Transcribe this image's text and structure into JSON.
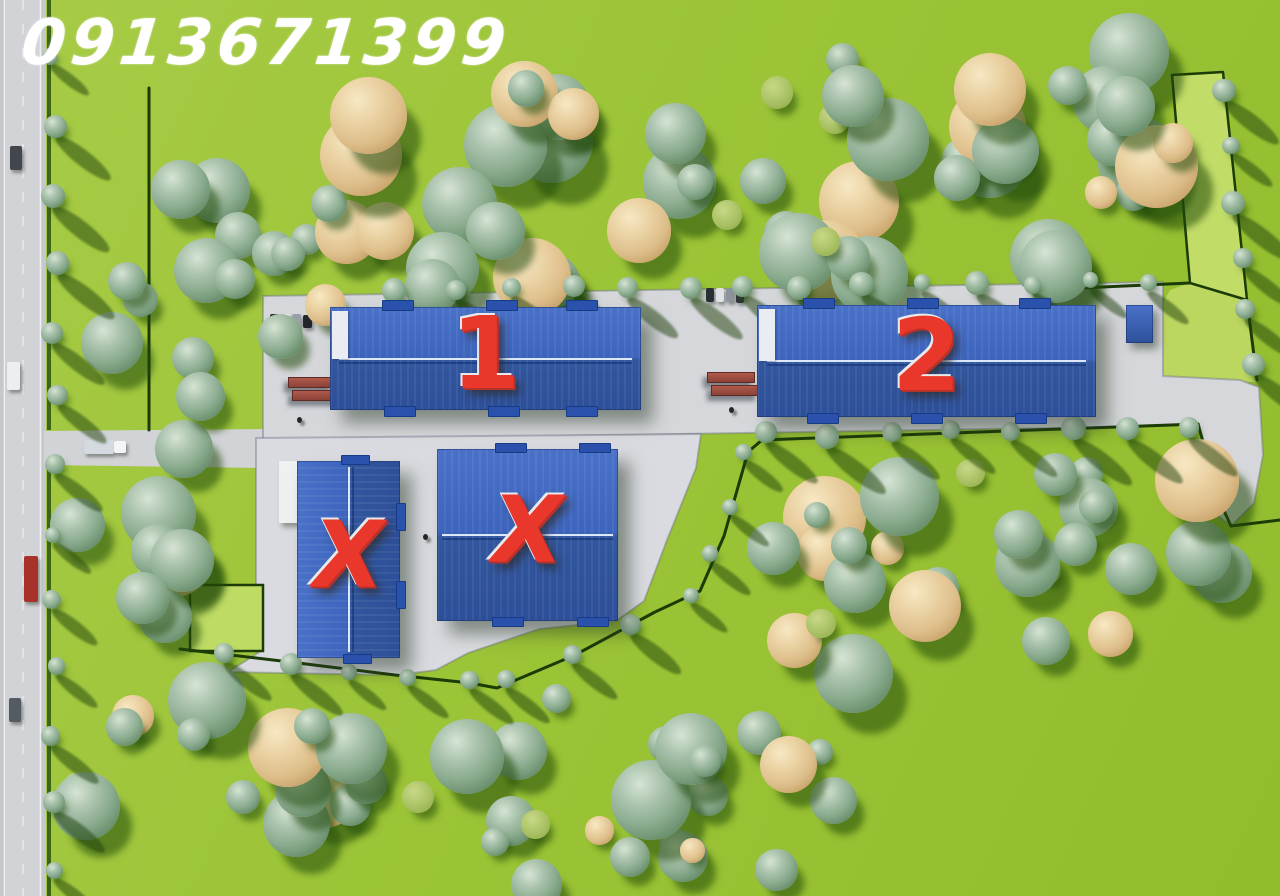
{
  "watermark": {
    "phone": "0913671399"
  },
  "buildings": [
    {
      "id": "warehouse-1",
      "label": "1"
    },
    {
      "id": "warehouse-2",
      "label": "2"
    },
    {
      "id": "warehouse-x-left",
      "label": "X"
    },
    {
      "id": "warehouse-x-center",
      "label": "X"
    }
  ],
  "colors": {
    "grass": "#9cc437",
    "grass_light_parcel": "#c2dc68",
    "pavement": "#d6d7db",
    "road": "#c6c7cb",
    "roof_blue_top": "#4a71c8",
    "roof_blue_bottom": "#2d4f99",
    "ridge_light": "#dde9fb",
    "label_red": "#ea372c",
    "boundary_dark": "#1c3b07",
    "tree_green": "#8aab8e",
    "tree_tan": "#ddbe8a",
    "dock_red": "#9c4b3f",
    "watermark_white": "#ffffff"
  },
  "scene": {
    "clusters": [
      {
        "cx": 215,
        "cy": 305,
        "rx": 115,
        "ry": 155,
        "n": 17,
        "seed": 7
      },
      {
        "cx": 515,
        "cy": 182,
        "rx": 195,
        "ry": 118,
        "n": 22,
        "seed": 13
      },
      {
        "cx": 850,
        "cy": 158,
        "rx": 155,
        "ry": 128,
        "n": 19,
        "seed": 29
      },
      {
        "cx": 1068,
        "cy": 158,
        "rx": 112,
        "ry": 128,
        "n": 14,
        "seed": 41
      },
      {
        "cx": 905,
        "cy": 570,
        "rx": 145,
        "ry": 122,
        "n": 16,
        "seed": 53
      },
      {
        "cx": 1118,
        "cy": 572,
        "rx": 115,
        "ry": 128,
        "n": 13,
        "seed": 67
      },
      {
        "cx": 215,
        "cy": 795,
        "rx": 175,
        "ry": 100,
        "n": 17,
        "seed": 79
      },
      {
        "cx": 555,
        "cy": 795,
        "rx": 175,
        "ry": 100,
        "n": 17,
        "seed": 97
      },
      {
        "cx": 122,
        "cy": 560,
        "rx": 70,
        "ry": 88,
        "n": 7,
        "seed": 103
      },
      {
        "cx": 755,
        "cy": 800,
        "rx": 85,
        "ry": 85,
        "n": 7,
        "seed": 113
      }
    ],
    "boundary_tree_rows": [
      {
        "x1": 54,
        "y1": 58,
        "x2": 54,
        "y2": 872,
        "n": 13
      },
      {
        "x1": 398,
        "y1": 290,
        "x2": 1150,
        "y2": 282,
        "n": 14
      },
      {
        "x1": 1228,
        "y1": 88,
        "x2": 1250,
        "y2": 368,
        "n": 6
      },
      {
        "x1": 770,
        "y1": 436,
        "x2": 1190,
        "y2": 425,
        "n": 8
      },
      {
        "x1": 228,
        "y1": 655,
        "x2": 468,
        "y2": 682,
        "n": 5
      },
      {
        "x1": 510,
        "y1": 679,
        "x2": 692,
        "y2": 597,
        "n": 4
      },
      {
        "x1": 714,
        "y1": 552,
        "x2": 746,
        "y2": 456,
        "n": 3
      }
    ],
    "vehicles": [
      {
        "x": 10,
        "y": 146,
        "w": 12,
        "h": 24,
        "c": "#42464d"
      },
      {
        "x": 7,
        "y": 362,
        "w": 13,
        "h": 28,
        "c": "#eceef0"
      },
      {
        "x": 24,
        "y": 556,
        "w": 14,
        "h": 46,
        "c": "#a8322a"
      },
      {
        "x": 9,
        "y": 698,
        "w": 12,
        "h": 24,
        "c": "#555b63"
      },
      {
        "x": 84,
        "y": 440,
        "w": 30,
        "h": 14,
        "c": "#d5d9e0"
      },
      {
        "x": 114,
        "y": 441,
        "w": 12,
        "h": 12,
        "c": "#f4f5f7"
      },
      {
        "x": 270,
        "y": 314,
        "w": 9,
        "h": 13,
        "c": "#2e3238"
      },
      {
        "x": 281,
        "y": 314,
        "w": 9,
        "h": 13,
        "c": "#e8eaec"
      },
      {
        "x": 292,
        "y": 314,
        "w": 9,
        "h": 13,
        "c": "#9aa0a8"
      },
      {
        "x": 303,
        "y": 315,
        "w": 9,
        "h": 13,
        "c": "#23272c"
      },
      {
        "x": 706,
        "y": 288,
        "w": 8,
        "h": 14,
        "c": "#2b2f35"
      },
      {
        "x": 716,
        "y": 288,
        "w": 8,
        "h": 14,
        "c": "#dfe1e4"
      },
      {
        "x": 726,
        "y": 288,
        "w": 8,
        "h": 14,
        "c": "#8d939b"
      },
      {
        "x": 736,
        "y": 289,
        "w": 8,
        "h": 14,
        "c": "#31353b"
      }
    ],
    "docks": [
      {
        "x": 288,
        "y": 377,
        "w": 44,
        "h": 9
      },
      {
        "x": 292,
        "y": 390,
        "w": 44,
        "h": 9
      },
      {
        "x": 707,
        "y": 372,
        "w": 46,
        "h": 9
      },
      {
        "x": 711,
        "y": 385,
        "w": 46,
        "h": 9
      }
    ],
    "persons": [
      {
        "x": 423,
        "y": 534
      },
      {
        "x": 297,
        "y": 417
      },
      {
        "x": 729,
        "y": 407
      }
    ]
  }
}
